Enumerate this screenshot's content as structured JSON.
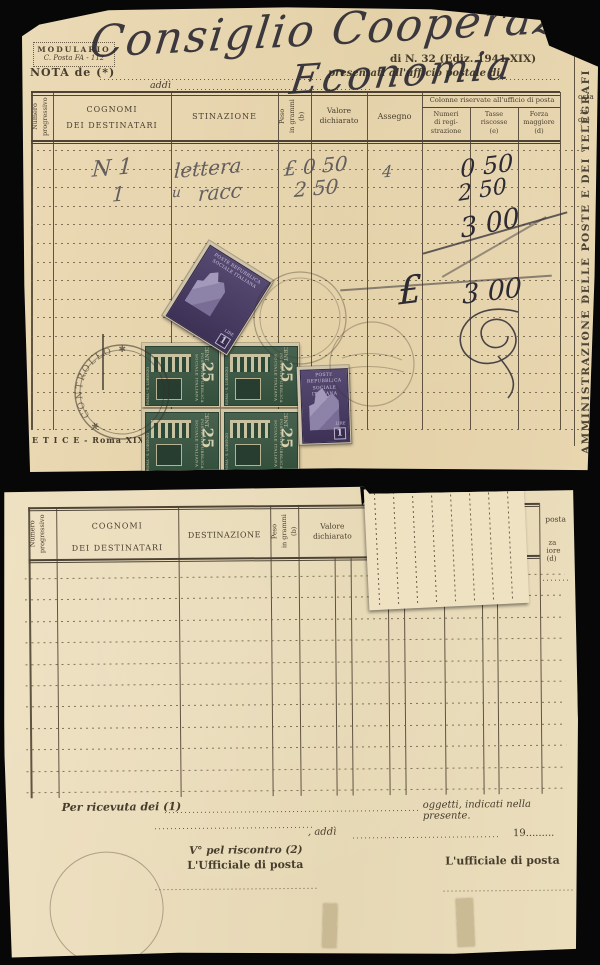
{
  "top_document": {
    "modulario": {
      "line1": "MODULARIO",
      "line2": "C. Posta FA - 112"
    },
    "edition": "di N. 32 (Ediz. 1941-XIX)",
    "nota_prefix": "NOTA de (*)",
    "presentati": "presentati all'ufficio postale di",
    "addi": "addì",
    "handwriting_line1": "Consiglio Cooperazione",
    "handwriting_line2": "Economia",
    "headers": {
      "numero": "Numero\nprogressivo",
      "cognomi": "COGNOMI\nDEI DESTINATARI",
      "destinazione": "STINAZIONE",
      "peso": "Peso\nin grammi\n(b)",
      "valore": "Valore\ndichiarato",
      "assegno": "Assegno",
      "office_title": "Colonne riservate all'ufficio di posta",
      "numeri": "Numeri\ndi regi-\nstrazione",
      "tasse": "Tasse\nriscosse\n(e)",
      "forza": "Forza\nmaggiore\n(d)"
    },
    "edge_fragments": {
      "l1": "osta",
      "l2": "za",
      "l3": "ore",
      "l4": ")"
    },
    "entries": {
      "row1_qty": "N 1",
      "row1_desc": "lettera",
      "row1_valore": "£ 0 50",
      "row1_assegno": "4",
      "row1_tasse": "0 50",
      "row2_qty": "1",
      "row2_ditto": "u",
      "row2_desc": "racc",
      "row2_valore": "2 50",
      "row2_tasse": "2 50",
      "subtotal": "3 00",
      "total_symbol": "£",
      "total": "3 00"
    },
    "side_text": "AMMINISTRAZIONE DELLE POSTE E DEI TELEGRAFI",
    "imprint": "E T I C E  -  Roma XIX  -  C",
    "postmark": "✱ CONTROLLO ✱",
    "stamps": {
      "green": {
        "country": "POSTE REPUBBLICA SOCIALE ITALIANA",
        "unit": "CENT.",
        "value": "25",
        "subject": "ROMA - S. LORENZO"
      },
      "violet": {
        "country": "POSTE REPUBBLICA\nSOCIALE ITALIANA",
        "unit": "LIRE",
        "value": "1"
      }
    }
  },
  "bottom_document": {
    "headers": {
      "numero": "Numero\nprogressivo",
      "cognomi": "COGNOMI\nDEI DESTINATARI",
      "destinazione": "DESTINAZIONE",
      "peso": "Peso\nin grammi\n(b)",
      "valore": "Valore\ndichiarato"
    },
    "edge_fragments": {
      "l1": "posta",
      "l2": "za",
      "l3": "iore",
      "l4": "(d)"
    },
    "footer": {
      "ricevuta": "Per ricevuta dei (1)",
      "oggetti": "oggetti, indicati nella presente.",
      "addi_label": ", addì",
      "year": "19.........",
      "riscontro": "V° pel riscontro (2)",
      "ufficiale1": "L'Ufficiale di posta",
      "ufficiale2": "L'ufficiale di posta"
    }
  },
  "colors": {
    "paper_top": "#e8d6b0",
    "paper_bottom": "#ecdfbe",
    "stamp_green": "#3c5a47",
    "stamp_violet": "#4a3c64",
    "ink": "#2d2b34"
  }
}
